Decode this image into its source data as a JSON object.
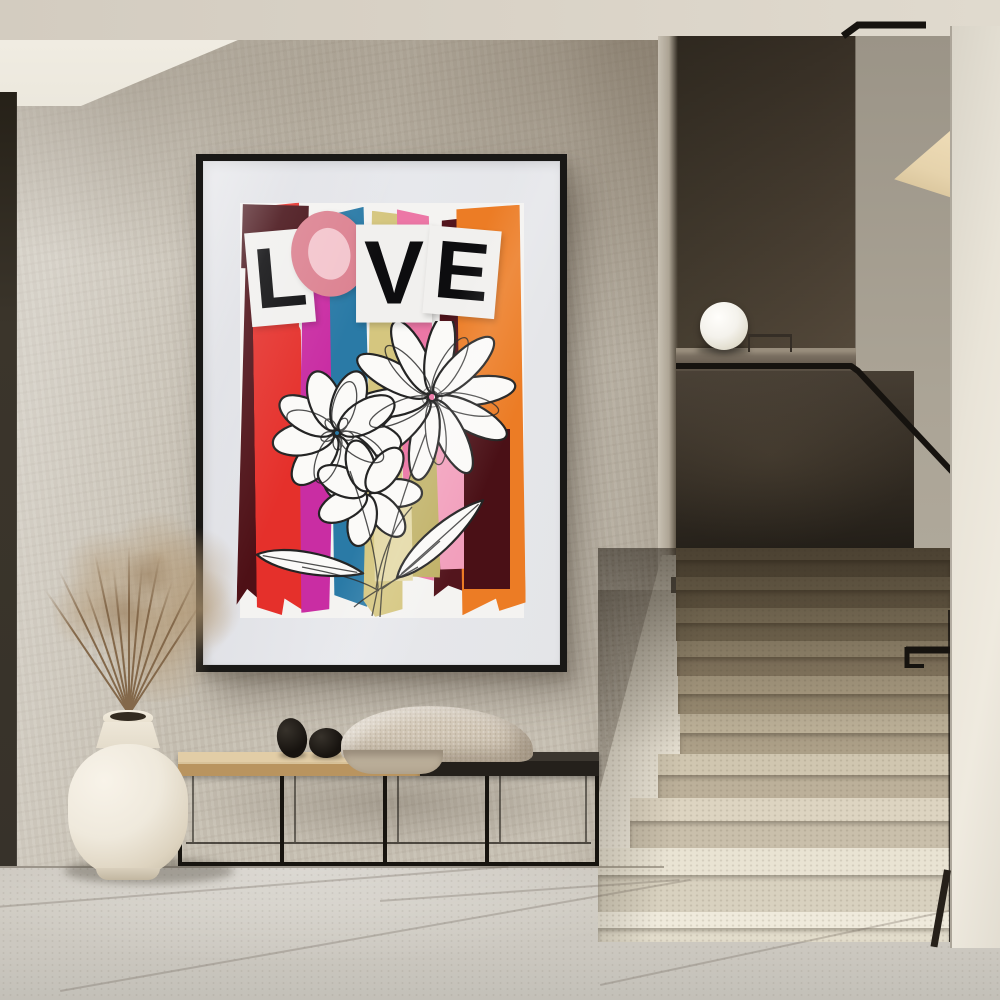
{
  "scene": {
    "poster": {
      "word": "LOVE",
      "letters": [
        "L",
        "O",
        "V",
        "E"
      ],
      "letter_color": "#0d0d0f",
      "o_ring_color": "#dc8291",
      "o_center_color": "#f3c5cd",
      "backing_color": "#f1f0ee",
      "frame_color": "#191816",
      "mat_color": "#e7e8ec",
      "art_background": "#f4f3f1",
      "flower_fill": "#fbfaf8",
      "flower_line": "#242424",
      "stripes": [
        {
          "name": "maroon",
          "color": "#4e1016"
        },
        {
          "name": "red",
          "color": "#e5302b"
        },
        {
          "name": "magenta",
          "color": "#c92da3"
        },
        {
          "name": "blue",
          "color": "#2a7aa6"
        },
        {
          "name": "khaki",
          "color": "#d5c67f"
        },
        {
          "name": "pink",
          "color": "#ec77a6"
        },
        {
          "name": "dark-maroon",
          "color": "#53151d"
        },
        {
          "name": "orange",
          "color": "#ec7c25"
        }
      ],
      "bits": [
        {
          "name": "maroon-block-top-left",
          "color": "#451016"
        },
        {
          "name": "khaki-offcut",
          "color": "#c0b166"
        },
        {
          "name": "pink-offcut",
          "color": "#f29fbc"
        },
        {
          "name": "pale-khaki-offcut",
          "color": "#e4d9a6"
        },
        {
          "name": "maroon-block-right",
          "color": "#4a1016"
        }
      ]
    },
    "palette": {
      "ceiling": "#d8d1c5",
      "wall": "#c8c1b4",
      "soffit": "#ece8dd",
      "doorEdge": "#37322a",
      "floor": "#cecac1",
      "column": "#e9e4d8",
      "sideWall": "#aba496",
      "shelf": "#e6d3ac",
      "ledge": "#7a6f61",
      "glassTop": "#4a4136",
      "glassBottom": "#201c16",
      "stepLight": "#efeadc",
      "stepDark": "#7b6d54",
      "rail": "#16130f",
      "lamp": "#f4f2ec",
      "benchWood": "#d8c299",
      "benchDark": "#24201b",
      "benchMetal": "#17140f",
      "blanket": "#d2c7b6",
      "pebble": "#17130f",
      "vase": "#efe9dc",
      "plantStem": "#83684a",
      "plantFluff": "#b29772"
    }
  }
}
